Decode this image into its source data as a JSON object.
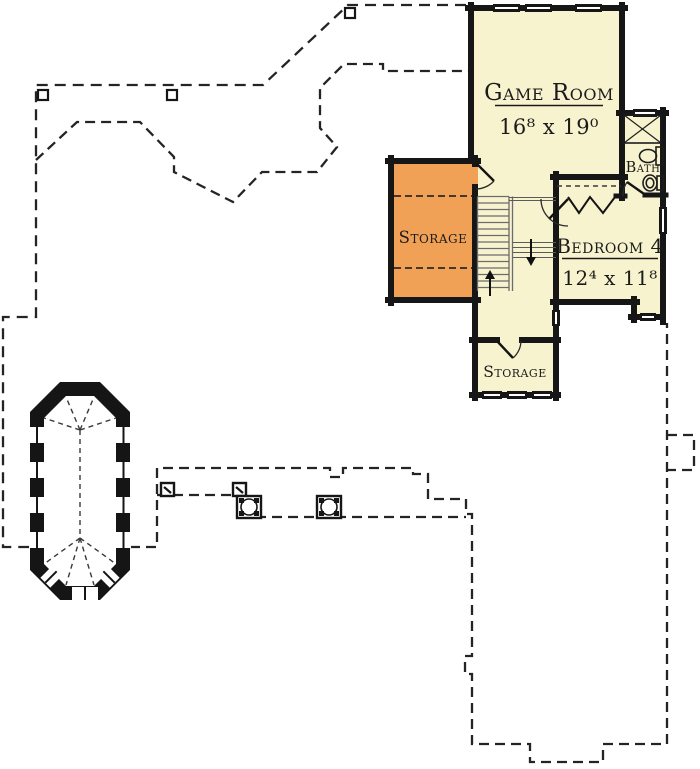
{
  "plan_title": "Upper floor plan",
  "rooms": {
    "game_room": {
      "name": "Game Room",
      "dims": "16⁸ x 19⁰"
    },
    "bedroom4": {
      "name": "Bedroom 4",
      "dims": "12⁴ x 11⁸"
    },
    "bath": {
      "name": "Bath"
    },
    "attic_storage": {
      "name": "Storage"
    },
    "lower_storage": {
      "name": "Storage"
    }
  },
  "colors": {
    "room_fill": "#F7F3CF",
    "storage_fill": "#F1A155",
    "wall": "#161616",
    "background": "#FFFFFF"
  }
}
